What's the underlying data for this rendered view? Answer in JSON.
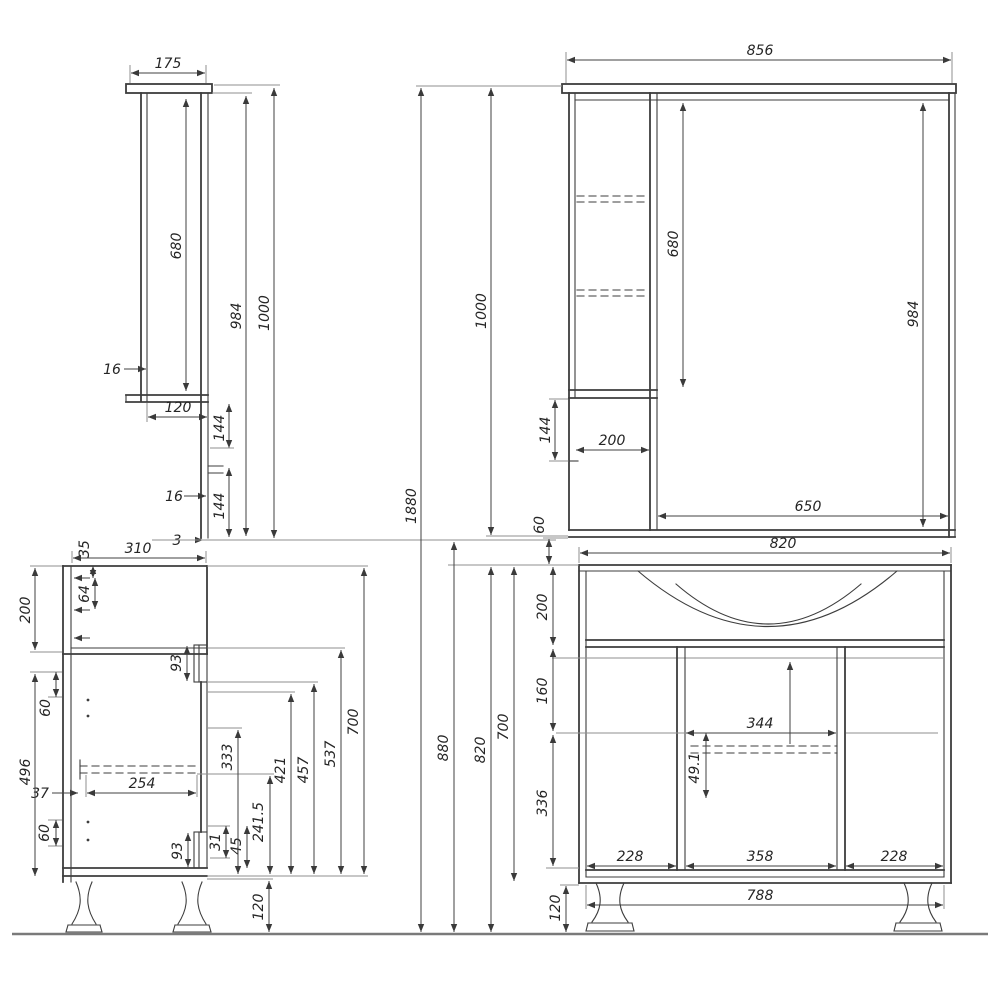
{
  "drawing": {
    "title": "Bathroom vanity and mirror cabinet dimensional drawing",
    "mirror_side": {
      "dims": {
        "width_top": "175",
        "cabinet_height": "680",
        "mirror_height": "984",
        "total_height": "1000",
        "wall_thickness": "16",
        "lower_depth": "120",
        "gap_upper": "144",
        "shelf_thickness": "16",
        "gap_lower": "144",
        "bottom_edge": "3"
      }
    },
    "mirror_front": {
      "dims": {
        "width_top": "856",
        "cabinet_height": "680",
        "mirror_height": "984",
        "total_height": "1000",
        "overall_height": "1880",
        "side_panel_drop": "144",
        "cabinet_width": "200",
        "mirror_width": "650",
        "wall_gap": "60"
      }
    },
    "vanity_side": {
      "dims": {
        "depth": "310",
        "top_inset": "35",
        "hinge_offset": "64",
        "upper_section": "200",
        "hinge_gap_upper": "60",
        "lower_section": "496",
        "slide_inset": "37",
        "slide_length": "254",
        "drawer_front_upper": "93",
        "height_333": "333",
        "height_421": "421",
        "height_457": "457",
        "height_537": "537",
        "body_height": "700",
        "height_241_5": "241.5",
        "height_31": "31",
        "height_45": "45",
        "drawer_front_lower": "93",
        "hinge_gap_lower": "60",
        "leg_height": "120"
      }
    },
    "vanity_front": {
      "dims": {
        "width": "820",
        "basin_section": "200",
        "mid_section": "160",
        "inner_width": "344",
        "rail_offset": "49.1",
        "lower_section": "336",
        "door_left": "228",
        "door_middle": "358",
        "door_right": "228",
        "leg_span": "788",
        "leg_height": "120",
        "height_to_floor": "880",
        "height_with_legs": "820",
        "body_height": "700"
      }
    }
  }
}
